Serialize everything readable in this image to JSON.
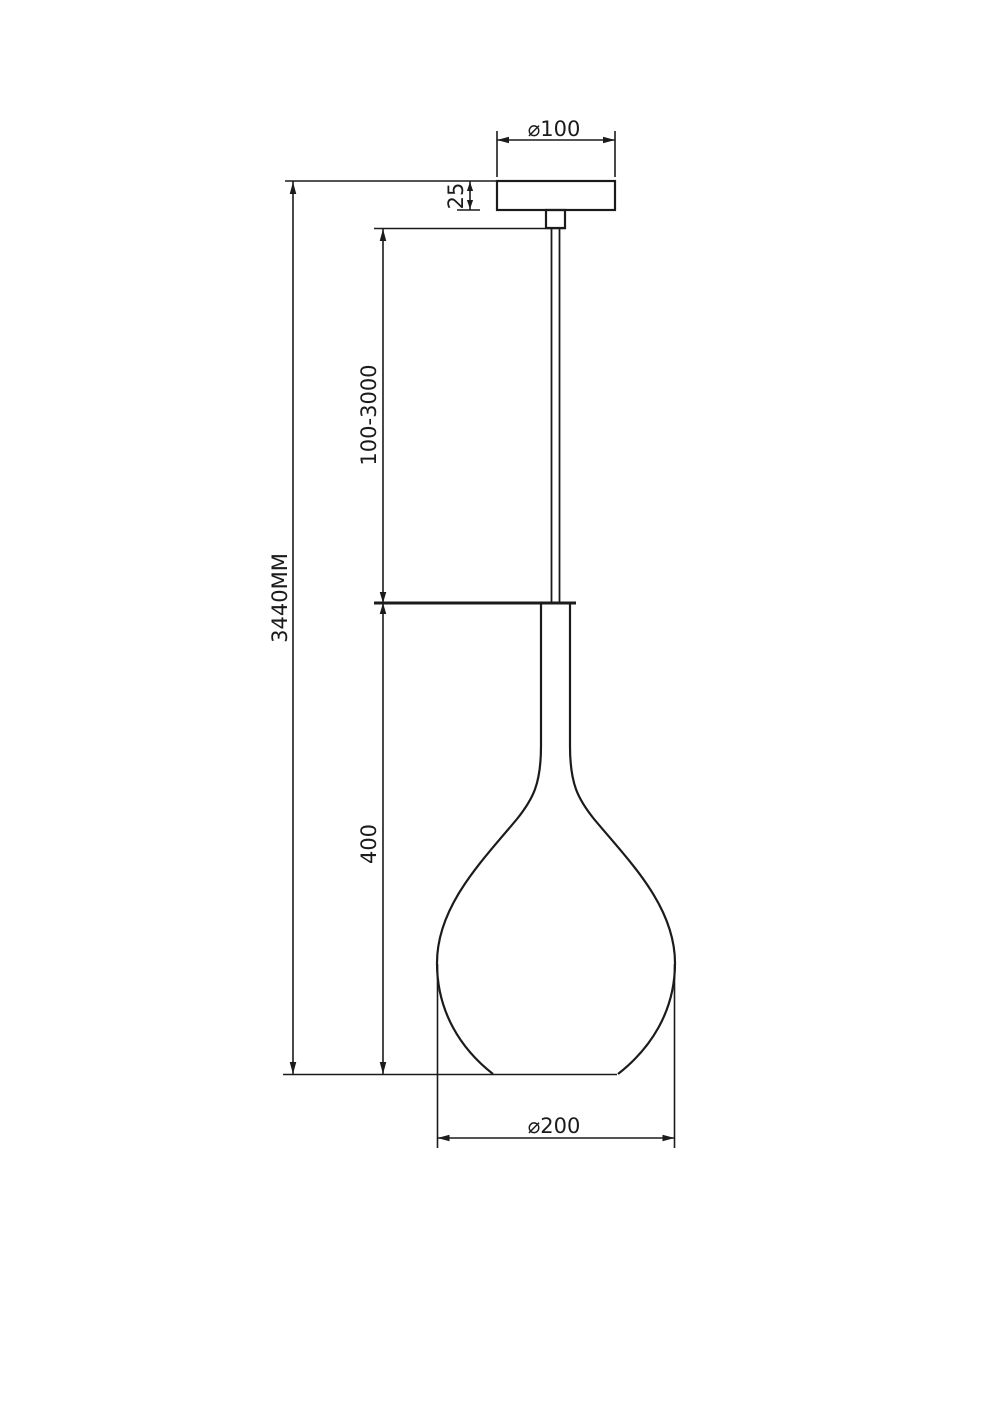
{
  "drawing": {
    "kind": "pendant-lamp-dimension-drawing",
    "background_color": "#ffffff",
    "line_color": "#1b1b1b",
    "labels": {
      "canopy_diameter": "⌀100",
      "canopy_height": "25",
      "suspension_length": "100-3000",
      "overall_height": "3440MM",
      "shade_height": "400",
      "shade_diameter": "⌀200"
    }
  }
}
